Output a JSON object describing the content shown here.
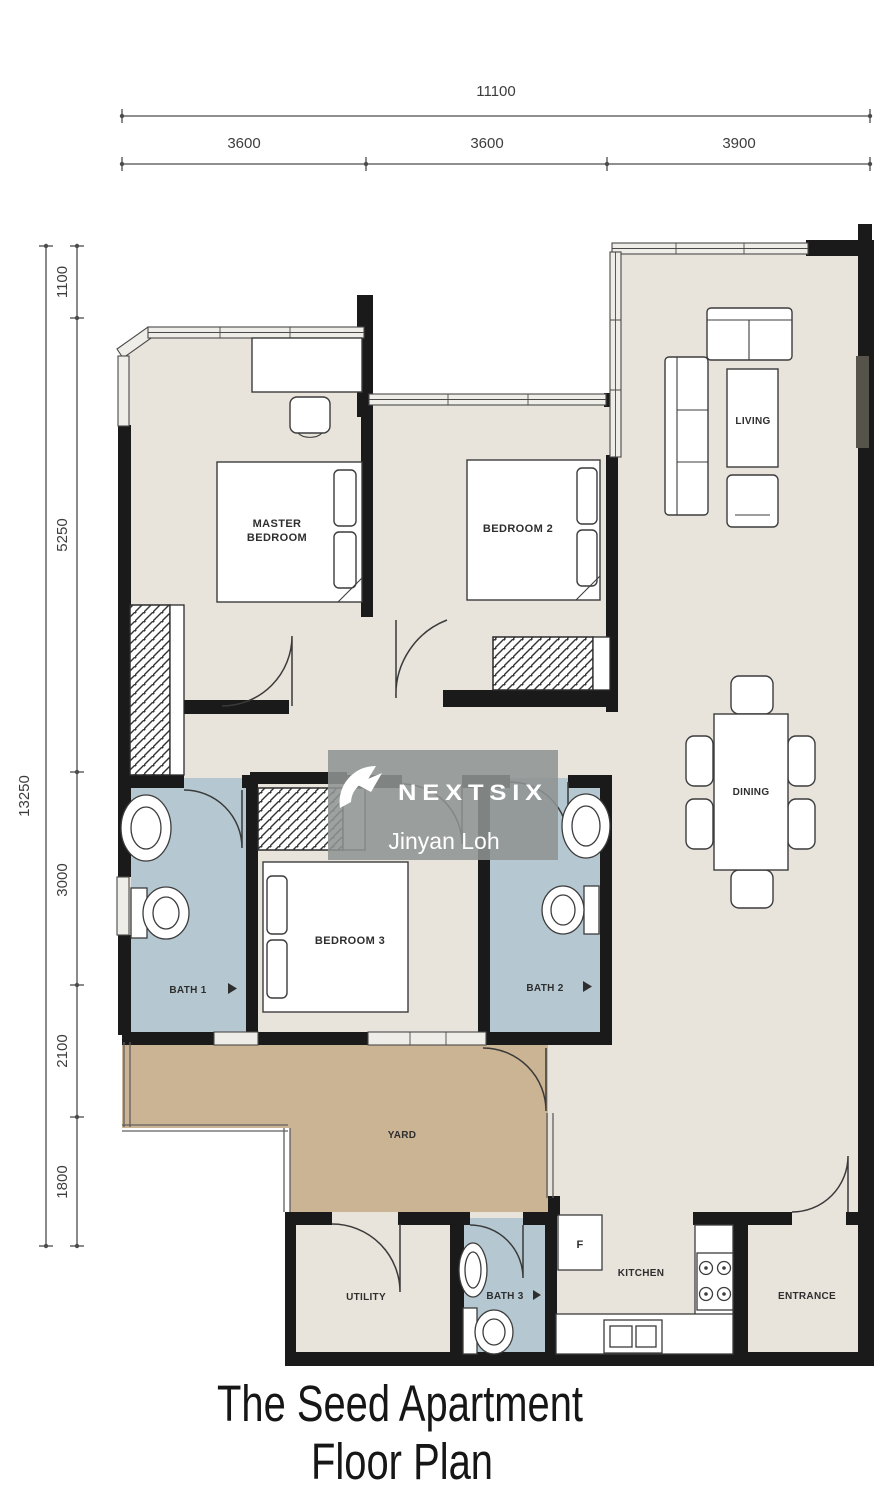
{
  "title": {
    "line1": "The Seed Apartment",
    "line2": "Floor Plan"
  },
  "watermark": {
    "brand": "NEXTSIX",
    "agent": "Jinyan Loh",
    "icon": "nextsix-swoosh-icon"
  },
  "dimensions": {
    "top": {
      "total": "11100",
      "segments": [
        "3600",
        "3600",
        "3900"
      ]
    },
    "left": {
      "total": "13250",
      "segments": [
        "1100",
        "5250",
        "3000",
        "2100",
        "1800"
      ]
    }
  },
  "rooms": {
    "master_bedroom": {
      "label": "MASTER BEDROOM",
      "lines": [
        "MASTER",
        "BEDROOM"
      ]
    },
    "bedroom2": {
      "label": "BEDROOM 2"
    },
    "bedroom3": {
      "label": "BEDROOM 3"
    },
    "living": {
      "label": "LIVING"
    },
    "dining": {
      "label": "DINING"
    },
    "bath1": {
      "label": "BATH 1"
    },
    "bath2": {
      "label": "BATH 2"
    },
    "bath3": {
      "label": "BATH 3"
    },
    "yard": {
      "label": "YARD"
    },
    "utility": {
      "label": "UTILITY"
    },
    "kitchen": {
      "label": "KITCHEN"
    },
    "entrance": {
      "label": "ENTRANCE"
    },
    "fridge": {
      "label": "F"
    }
  },
  "colors": {
    "floor": "#e8e4db",
    "bath": "#b5c8d1",
    "yard": "#cbb494",
    "window": "#efede7",
    "wall": "#1a1a1a",
    "dimension_lines": "#4c4c4c",
    "watermark_bg": "#8f9392",
    "watermark_text": "#ffffff",
    "furniture": "#ffffff",
    "title_text": "#161616"
  }
}
